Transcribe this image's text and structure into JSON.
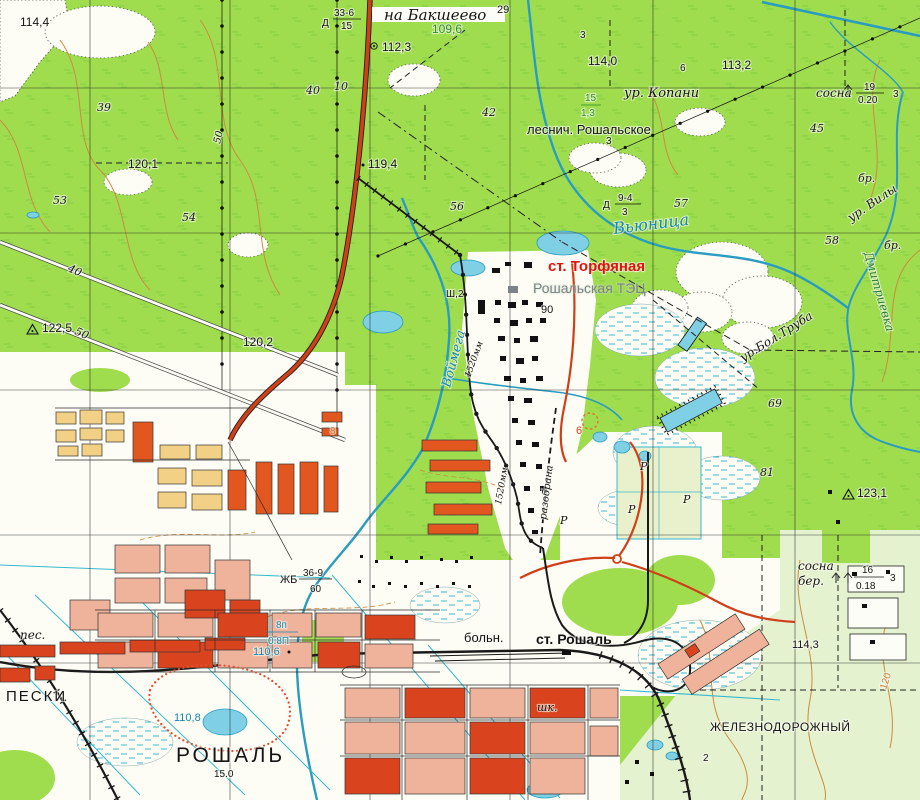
{
  "map": {
    "type": "topographic-map",
    "palette": {
      "forest_green": "#9fdd4e",
      "sparse_green": "#e4f2cf",
      "field_white": "#fdfdf6",
      "water_fill": "#7fd0e4",
      "water_line": "#2a9cc0",
      "contour_orange": "#cf8a3e",
      "road_red": "#cf4018",
      "rail_black": "#1a1a1a",
      "block_salmon": "#efb29b",
      "block_red": "#d9441f",
      "block_yellow": "#f2d186",
      "block_orange": "#e2571f",
      "label_red": "#e01212",
      "label_green": "#2e8b2e",
      "label_blue": "#1787ad",
      "label_gray": "#7d8287"
    },
    "labels": [
      {
        "id": "na-baksheevo",
        "t": "на Бакшеево",
        "x": 384,
        "y": 20,
        "s": 15,
        "c": "i"
      },
      {
        "id": "num-29",
        "t": "29",
        "x": 497,
        "y": 13,
        "s": 11,
        "c": "k"
      },
      {
        "id": "kv-33-6",
        "t": "33-6",
        "x": 334,
        "y": 16,
        "s": 10,
        "c": "k"
      },
      {
        "id": "kv-15",
        "t": "15",
        "x": 341,
        "y": 29,
        "s": 10,
        "c": "k"
      },
      {
        "id": "d-sign-1",
        "t": "Д",
        "x": 322,
        "y": 26,
        "s": 10,
        "c": "k"
      },
      {
        "id": "h-112-3",
        "t": "112,3",
        "x": 382,
        "y": 51,
        "s": 12,
        "c": "k"
      },
      {
        "id": "h-109-6",
        "t": "109,6",
        "x": 432,
        "y": 33,
        "s": 12,
        "c": "g"
      },
      {
        "id": "h-114-4",
        "t": "114,4",
        "x": 20,
        "y": 26,
        "s": 12,
        "c": "k"
      },
      {
        "id": "h-114-0",
        "t": "114,0",
        "x": 588,
        "y": 65,
        "s": 12,
        "c": "k"
      },
      {
        "id": "h-113-2",
        "t": "113,2",
        "x": 722,
        "y": 69,
        "s": 12,
        "c": "k"
      },
      {
        "id": "ur-kopani",
        "t": "ур. Копани",
        "x": 624,
        "y": 97,
        "s": 13,
        "c": "i"
      },
      {
        "id": "sosna-1",
        "t": "сосна",
        "x": 816,
        "y": 97,
        "s": 12,
        "c": "i"
      },
      {
        "id": "f-19",
        "t": "19",
        "x": 864,
        "y": 90,
        "s": 10,
        "c": "k"
      },
      {
        "id": "f-020",
        "t": "0.20",
        "x": 858,
        "y": 103,
        "s": 10,
        "c": "k"
      },
      {
        "id": "n-3a",
        "t": "3",
        "x": 893,
        "y": 97,
        "s": 10,
        "c": "k"
      },
      {
        "id": "lesnich",
        "t": "леснич. Рошальское",
        "x": 527,
        "y": 134,
        "s": 13,
        "c": "k"
      },
      {
        "id": "n-45",
        "t": "45",
        "x": 810,
        "y": 132,
        "s": 11,
        "c": "i"
      },
      {
        "id": "n-3b",
        "t": "3",
        "x": 606,
        "y": 144,
        "s": 10,
        "c": "k"
      },
      {
        "id": "br-1",
        "t": "бр.",
        "x": 858,
        "y": 182,
        "s": 11,
        "c": "i"
      },
      {
        "id": "br-2",
        "t": "бр.",
        "x": 884,
        "y": 249,
        "s": 11,
        "c": "i"
      },
      {
        "id": "ur-vily",
        "t": "ур. Вилы",
        "x": 851,
        "y": 222,
        "s": 12,
        "c": "i",
        "r": -34
      },
      {
        "id": "vyunitsa",
        "t": "Вьюница",
        "x": 614,
        "y": 234,
        "s": 16,
        "c": "r",
        "r": -7
      },
      {
        "id": "dmitrievka",
        "t": "Дмитриевка",
        "x": 864,
        "y": 253,
        "s": 12,
        "c": "gr",
        "r": 74
      },
      {
        "id": "d-sign-2",
        "t": "Д",
        "x": 603,
        "y": 208,
        "s": 10,
        "c": "k"
      },
      {
        "id": "f-9-4",
        "t": "9-4",
        "x": 618,
        "y": 201,
        "s": 10,
        "c": "k"
      },
      {
        "id": "f-3",
        "t": "3",
        "x": 622,
        "y": 215,
        "s": 10,
        "c": "k"
      },
      {
        "id": "n-57",
        "t": "57",
        "x": 674,
        "y": 207,
        "s": 11,
        "c": "i"
      },
      {
        "id": "n-58",
        "t": "58",
        "x": 825,
        "y": 244,
        "s": 11,
        "c": "i"
      },
      {
        "id": "n-56",
        "t": "56",
        "x": 450,
        "y": 210,
        "s": 11,
        "c": "i"
      },
      {
        "id": "n-54",
        "t": "54",
        "x": 182,
        "y": 221,
        "s": 11,
        "c": "i"
      },
      {
        "id": "n-53",
        "t": "53",
        "x": 53,
        "y": 204,
        "s": 11,
        "c": "i"
      },
      {
        "id": "n-39",
        "t": "39",
        "x": 97,
        "y": 111,
        "s": 11,
        "c": "i"
      },
      {
        "id": "n-42",
        "t": "42",
        "x": 482,
        "y": 116,
        "s": 11,
        "c": "i"
      },
      {
        "id": "n-40t",
        "t": "40",
        "x": 306,
        "y": 94,
        "s": 11,
        "c": "i"
      },
      {
        "id": "n-10",
        "t": "10",
        "x": 334,
        "y": 90,
        "s": 11,
        "c": "i"
      },
      {
        "id": "n-3top",
        "t": "3",
        "x": 580,
        "y": 38,
        "s": 10,
        "c": "k"
      },
      {
        "id": "n-6a",
        "t": "6",
        "x": 680,
        "y": 71,
        "s": 10,
        "c": "k"
      },
      {
        "id": "g-15",
        "t": "15",
        "x": 585,
        "y": 101,
        "s": 10,
        "c": "g"
      },
      {
        "id": "g-1-3",
        "t": "1,3",
        "x": 581,
        "y": 116,
        "s": 10,
        "c": "g"
      },
      {
        "id": "h-120-1",
        "t": "120,1",
        "x": 128,
        "y": 168,
        "s": 12,
        "c": "k"
      },
      {
        "id": "h-119-4",
        "t": "119,4",
        "x": 368,
        "y": 168,
        "s": 12,
        "c": "k"
      },
      {
        "id": "h-122-5",
        "t": "122,5",
        "x": 42,
        "y": 332,
        "s": 12,
        "c": "k"
      },
      {
        "id": "h-120-2",
        "t": "120,2",
        "x": 243,
        "y": 346,
        "s": 12,
        "c": "k"
      },
      {
        "id": "sh-2",
        "t": "Ш,2",
        "x": 446,
        "y": 297,
        "s": 10,
        "c": "k"
      },
      {
        "id": "st-torfyanaya",
        "t": "ст. Торфяная",
        "x": 548,
        "y": 271,
        "s": 15,
        "c": "rd",
        "w": 1
      },
      {
        "id": "roshalskaya-tec",
        "t": "Рошальская ТЭЦ",
        "x": 533,
        "y": 293,
        "s": 14,
        "c": "gy"
      },
      {
        "id": "n-90",
        "t": "90",
        "x": 541,
        "y": 313,
        "s": 11,
        "c": "k"
      },
      {
        "id": "voymega",
        "t": "Воймега",
        "x": 450,
        "y": 388,
        "s": 13,
        "c": "r",
        "r": -75
      },
      {
        "id": "gauge-1520-a",
        "t": "1520мм",
        "x": 470,
        "y": 378,
        "s": 9,
        "c": "i",
        "r": -70
      },
      {
        "id": "gauge-1520-b",
        "t": "1520мм",
        "x": 501,
        "y": 505,
        "s": 9,
        "c": "i",
        "r": -80
      },
      {
        "id": "razobrana",
        "t": "разобрана",
        "x": 546,
        "y": 520,
        "s": 10,
        "c": "i",
        "r": -83
      },
      {
        "id": "n-69",
        "t": "69",
        "x": 768,
        "y": 407,
        "s": 11,
        "c": "i"
      },
      {
        "id": "n-81",
        "t": "81",
        "x": 760,
        "y": 476,
        "s": 11,
        "c": "i"
      },
      {
        "id": "h-123-1",
        "t": "123,1",
        "x": 857,
        "y": 497,
        "s": 12,
        "c": "k"
      },
      {
        "id": "sosna-2",
        "t": "сосна",
        "x": 798,
        "y": 570,
        "s": 12,
        "c": "i"
      },
      {
        "id": "ber",
        "t": "бер.",
        "x": 798,
        "y": 585,
        "s": 12,
        "c": "i"
      },
      {
        "id": "f-16",
        "t": "16",
        "x": 862,
        "y": 573,
        "s": 10,
        "c": "k"
      },
      {
        "id": "f-018",
        "t": "0.18",
        "x": 856,
        "y": 589,
        "s": 10,
        "c": "k"
      },
      {
        "id": "n-3c",
        "t": "3",
        "x": 890,
        "y": 581,
        "s": 10,
        "c": "k"
      },
      {
        "id": "ur-bol-truba",
        "t": "ур.Бол.Труба",
        "x": 743,
        "y": 362,
        "s": 12,
        "c": "i",
        "r": -32
      },
      {
        "id": "h-110-6",
        "t": "110,6",
        "x": 253,
        "y": 655,
        "s": 11,
        "c": "b"
      },
      {
        "id": "b-8p",
        "t": "8п",
        "x": 276,
        "y": 628,
        "s": 10,
        "c": "b"
      },
      {
        "id": "b-08p",
        "t": "0.8П",
        "x": 268,
        "y": 644,
        "s": 10,
        "c": "b"
      },
      {
        "id": "h-110-8",
        "t": "110,8",
        "x": 174,
        "y": 721,
        "s": 11,
        "c": "b"
      },
      {
        "id": "peski",
        "t": "ПЕСКИ",
        "x": 6,
        "y": 701,
        "s": 15,
        "c": "k",
        "ls": 2
      },
      {
        "id": "pes",
        "t": "пес.",
        "x": 20,
        "y": 639,
        "s": 12,
        "c": "i"
      },
      {
        "id": "roshal",
        "t": "РОШАЛЬ",
        "x": 176,
        "y": 762,
        "s": 21,
        "c": "k",
        "ls": 3
      },
      {
        "id": "h-15-0",
        "t": "15.0",
        "x": 214,
        "y": 777,
        "s": 10,
        "c": "k"
      },
      {
        "id": "boln",
        "t": "больн.",
        "x": 464,
        "y": 642,
        "s": 13,
        "c": "k"
      },
      {
        "id": "st-roshal",
        "t": "ст. Рошаль",
        "x": 536,
        "y": 644,
        "s": 14,
        "c": "k",
        "w": 1
      },
      {
        "id": "shk",
        "t": "шк.",
        "x": 537,
        "y": 711,
        "s": 11,
        "c": "i"
      },
      {
        "id": "zheleznodorozhny",
        "t": "ЖЕЛЕЗНОДОРОЖНЫЙ",
        "x": 710,
        "y": 731,
        "s": 12,
        "c": "k",
        "ls": 0.5
      },
      {
        "id": "h-114-3",
        "t": "114,3",
        "x": 792,
        "y": 648,
        "s": 11,
        "c": "k"
      },
      {
        "id": "c-120",
        "t": "120",
        "x": 886,
        "y": 690,
        "s": 10,
        "c": "o",
        "r": -72
      },
      {
        "id": "zhb",
        "t": "ЖБ",
        "x": 280,
        "y": 583,
        "s": 11,
        "c": "k"
      },
      {
        "id": "f-36-9",
        "t": "36-9",
        "x": 303,
        "y": 576,
        "s": 10,
        "c": "k"
      },
      {
        "id": "f-60",
        "t": "60",
        "x": 310,
        "y": 592,
        "s": 10,
        "c": "k"
      },
      {
        "id": "p-50",
        "t": "50",
        "x": 220,
        "y": 144,
        "s": 10,
        "c": "i",
        "r": -78
      },
      {
        "id": "r-40",
        "t": "40",
        "x": 67,
        "y": 271,
        "s": 11,
        "c": "i",
        "r": 23
      },
      {
        "id": "r-50",
        "t": "50",
        "x": 74,
        "y": 334,
        "s": 11,
        "c": "i",
        "r": 23
      },
      {
        "id": "red-6",
        "t": "6",
        "x": 576,
        "y": 434,
        "s": 11,
        "c": "rd2"
      },
      {
        "id": "n-2b",
        "t": "2",
        "x": 703,
        "y": 761,
        "s": 10,
        "c": "k"
      },
      {
        "id": "n-8o",
        "t": "8",
        "x": 330,
        "y": 434,
        "s": 10,
        "c": "o"
      },
      {
        "id": "peat-p1",
        "t": "Р",
        "x": 640,
        "y": 470,
        "s": 11,
        "c": "i"
      },
      {
        "id": "peat-p2",
        "t": "Р",
        "x": 628,
        "y": 513,
        "s": 11,
        "c": "i"
      },
      {
        "id": "peat-p3",
        "t": "Р",
        "x": 683,
        "y": 503,
        "s": 11,
        "c": "i"
      },
      {
        "id": "peat-p4",
        "t": "Р",
        "x": 560,
        "y": 524,
        "s": 11,
        "c": "i"
      }
    ]
  }
}
